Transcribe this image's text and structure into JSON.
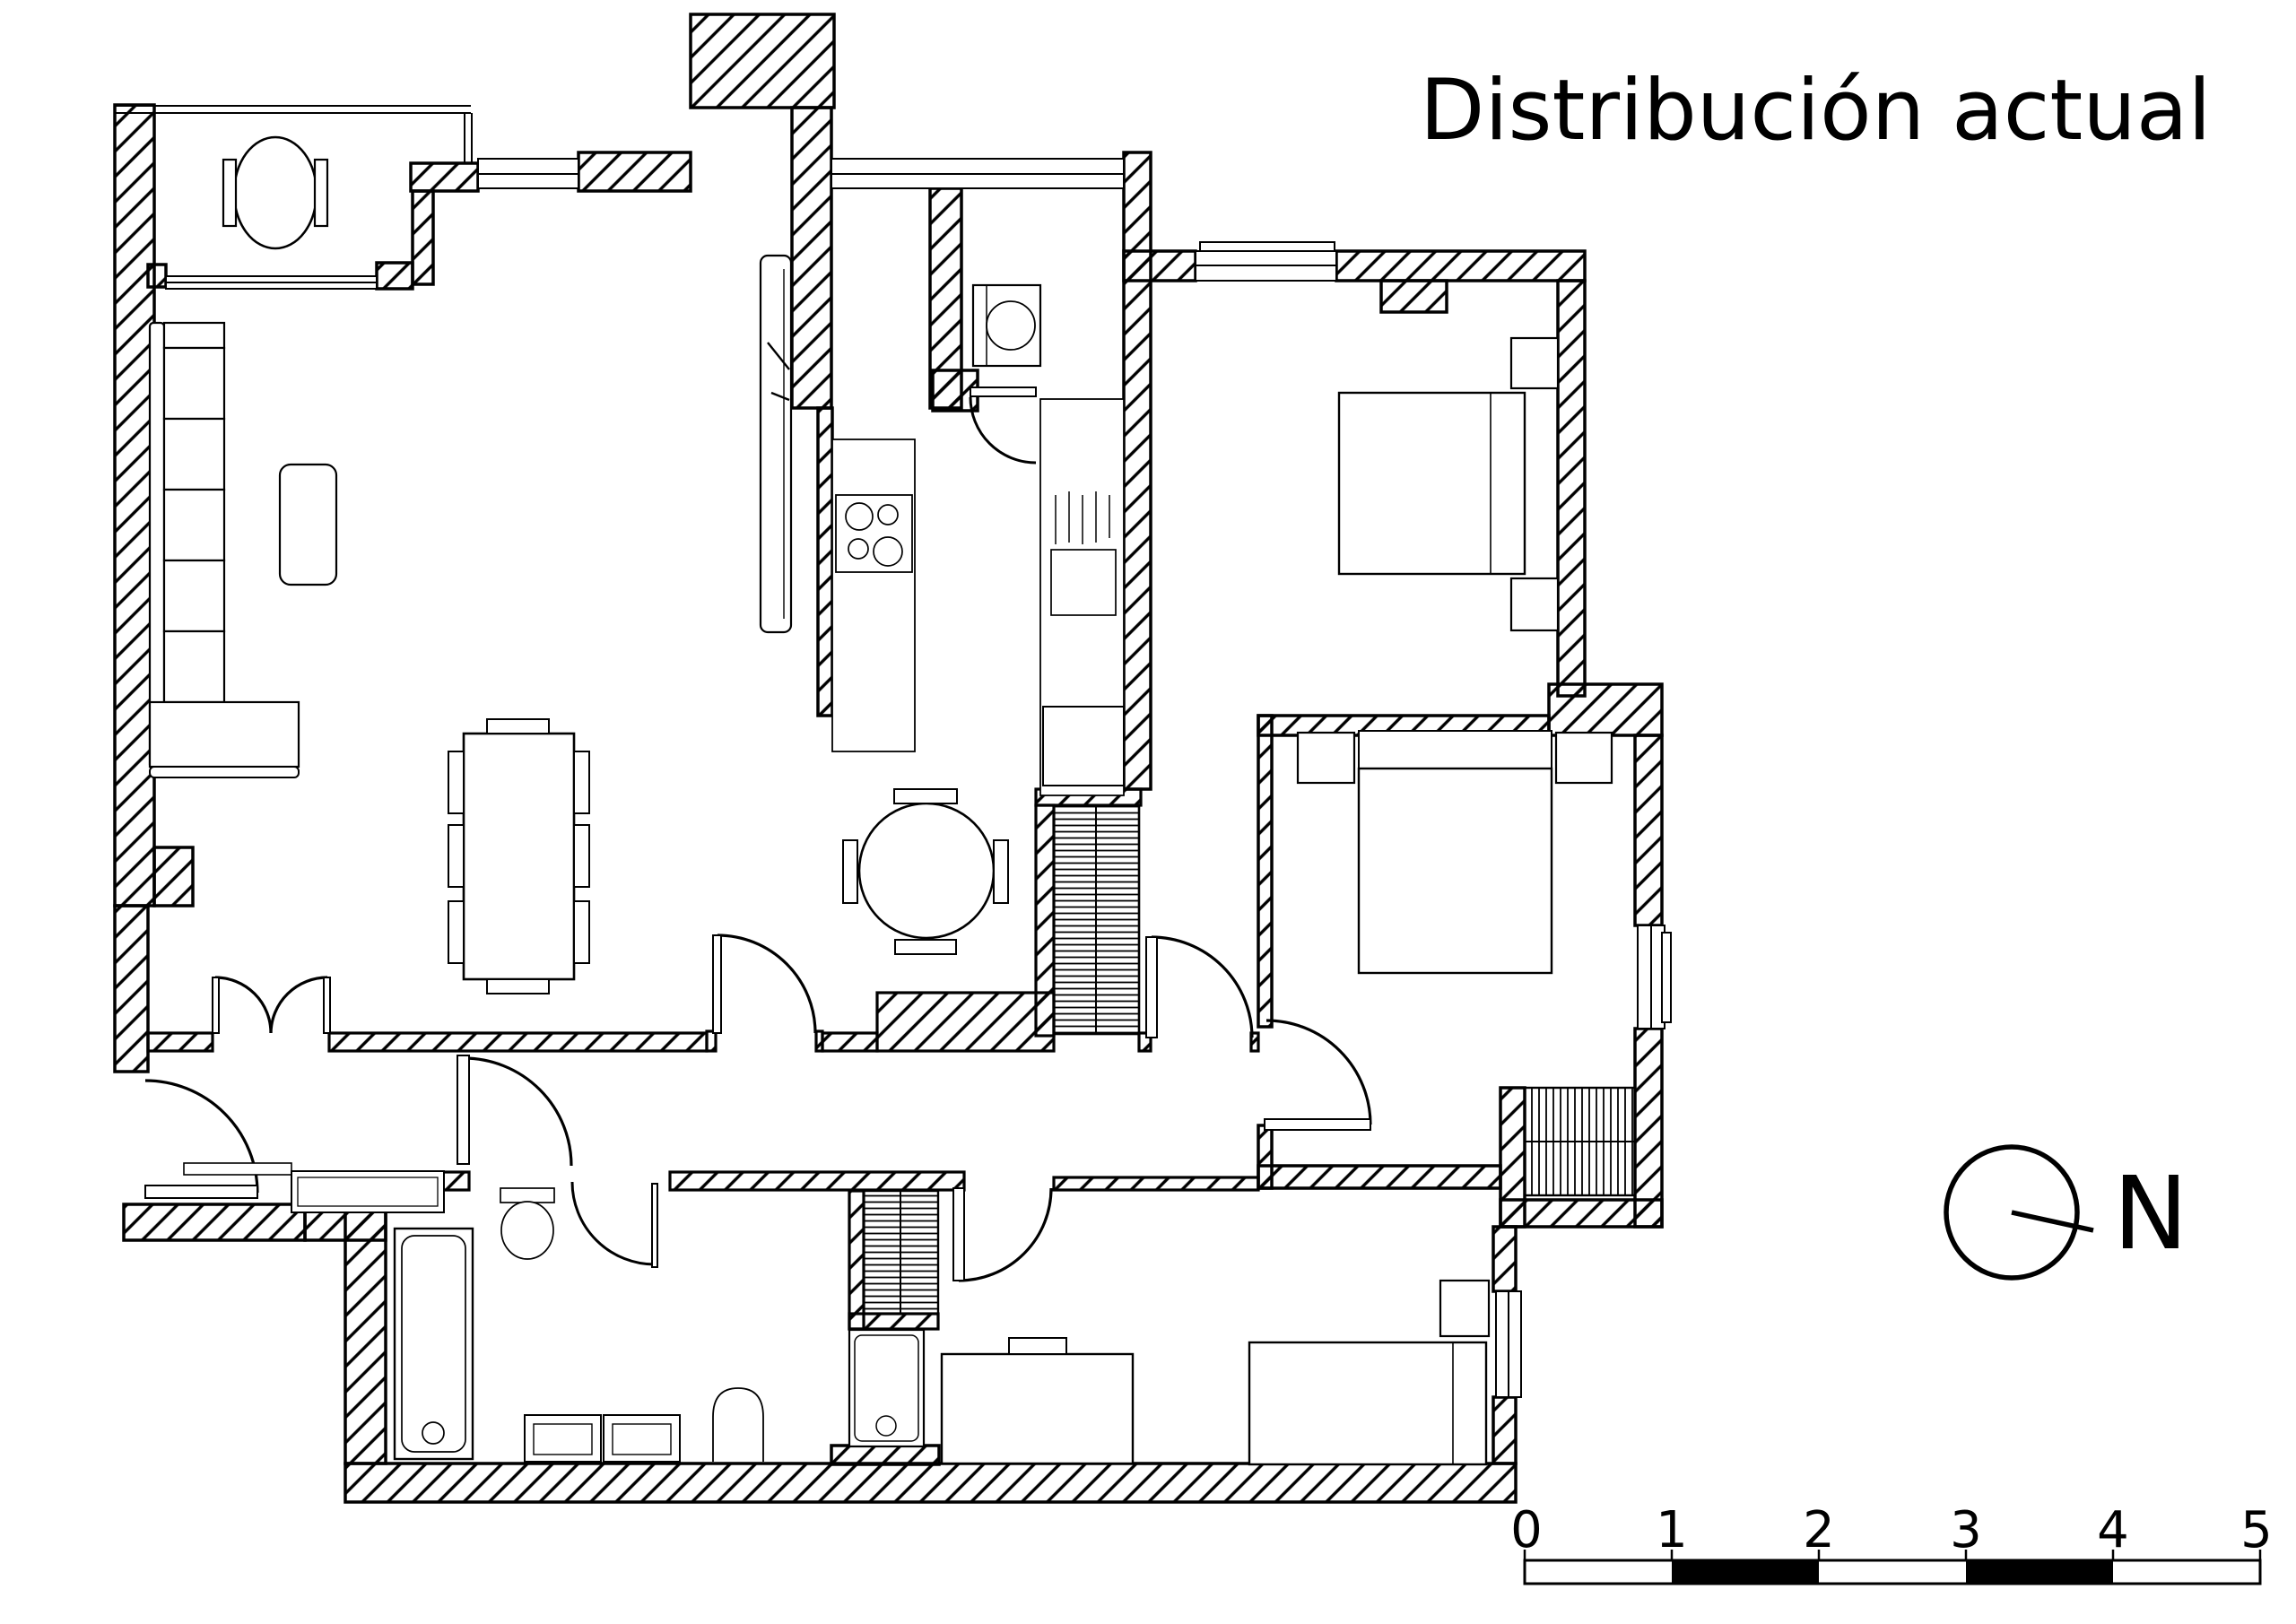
{
  "title": "Distribución actual",
  "compass": {
    "label": "N"
  },
  "scale_bar": {
    "labels": [
      "0",
      "1",
      "2",
      "3",
      "4",
      "5"
    ]
  },
  "colors": {
    "ink": "#000000",
    "paper": "#ffffff"
  }
}
